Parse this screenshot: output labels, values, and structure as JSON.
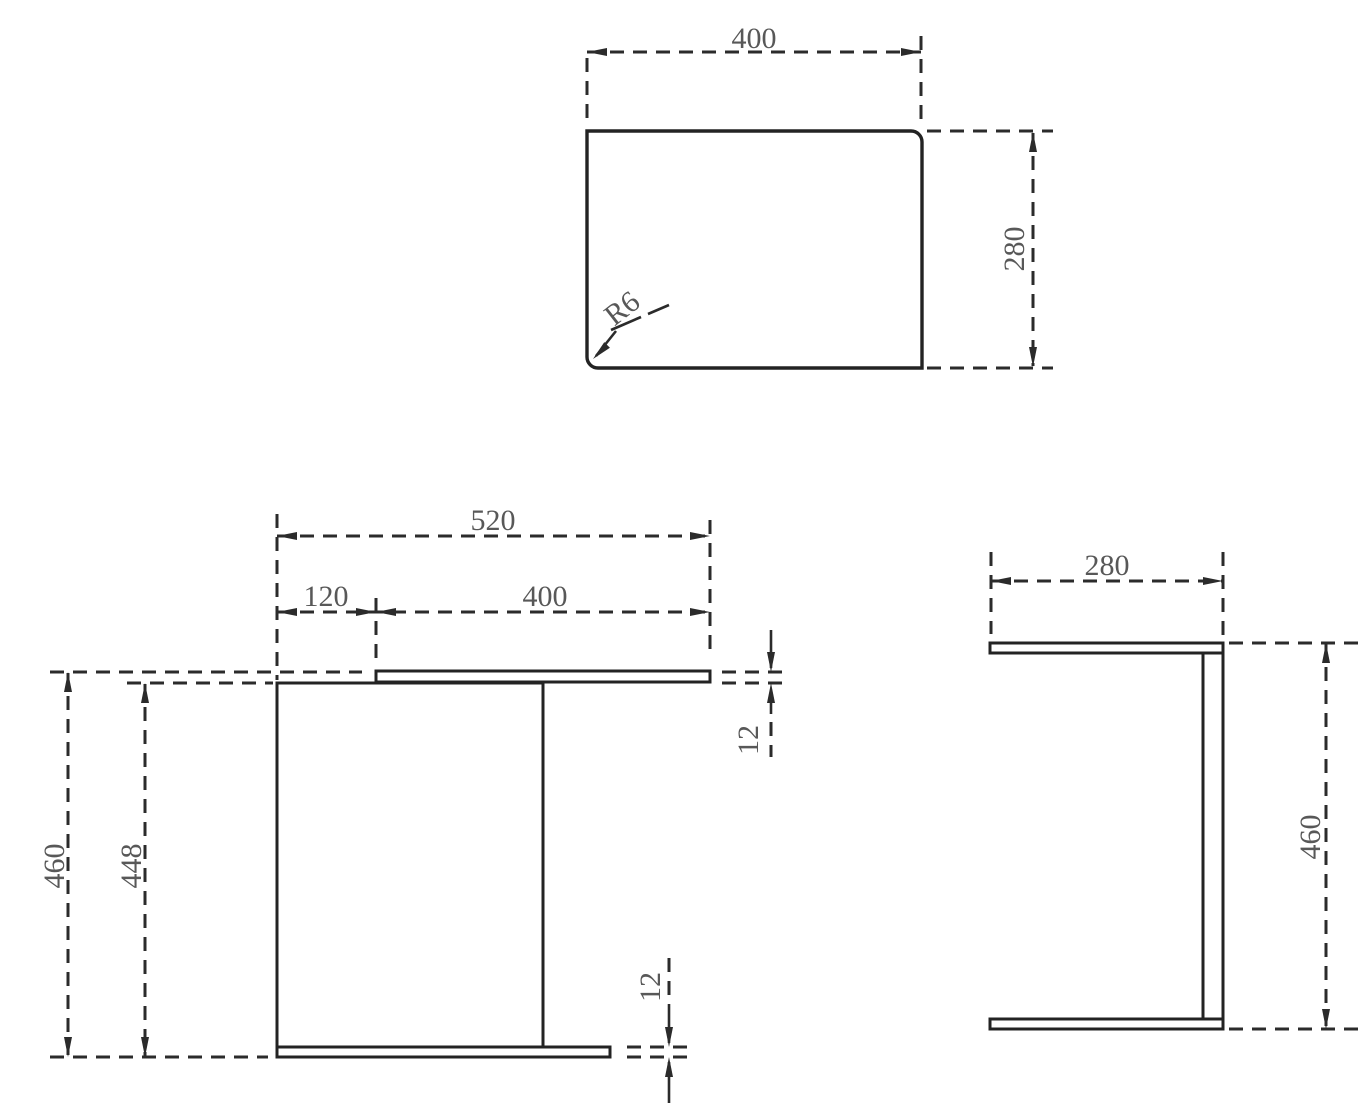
{
  "colors": {
    "background": "#ffffff",
    "line": "#2b2b2b",
    "text": "#585858"
  },
  "views": {
    "top": {
      "name": "top view",
      "dims": {
        "width": "400",
        "depth": "280",
        "corner_radius": "R6"
      }
    },
    "front": {
      "name": "front view",
      "dims": {
        "overall_width": "520",
        "top_offset": "120",
        "top_width": "400",
        "top_thickness": "12",
        "overall_height": "460",
        "panel_height": "448",
        "bottom_thickness": "12"
      }
    },
    "side": {
      "name": "side view",
      "dims": {
        "depth": "280",
        "height": "460"
      }
    }
  }
}
